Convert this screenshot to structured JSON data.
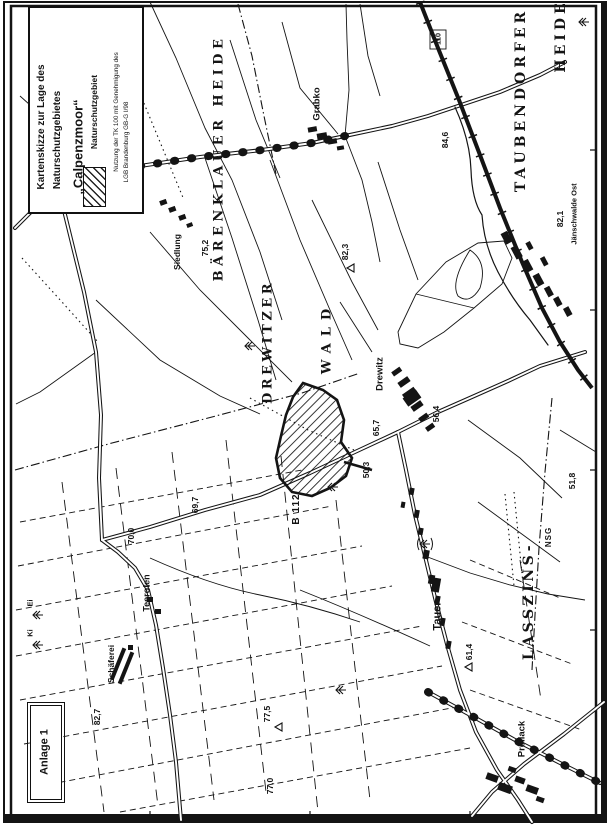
{
  "legend": {
    "title_line1": "Kartenskizze zur Lage des",
    "title_line2": "Naturschutzgebietes",
    "title_line3": "„Calpenzmoor“",
    "swatch_label": "Naturschutzgebiet",
    "note_line1": "Nutzung der TK 100 mit Genehmigung des",
    "note_line2": "LGB Brandenburg GB-G I/98"
  },
  "annotation_box": {
    "label": "Anlage 1"
  },
  "map": {
    "areas": {
      "barenklauer_heide": "BÄRENKLAUER HEIDE",
      "drewitzer": "DREWITZER",
      "wald": "WALD",
      "taubendorfer": "TAUBENDORFER",
      "heide": "HEIDE",
      "lasszins": "LASSZINS-",
      "nsg": "NSG"
    },
    "places": {
      "vorwerk": "Vorwerk",
      "grabko": "Grabko",
      "siedlung": "Siedlung",
      "drewitz": "Drewitz",
      "tauer": "Tauer",
      "teerofen": "Teerofen",
      "schaeferei": "Schäferei",
      "preilack": "Preilack",
      "jaenschwalde_ost": "Jänschwalde Ost",
      "ei": "Ei",
      "ki": "Ki"
    },
    "roads": {
      "b112": "B 112",
      "road_110": "110"
    },
    "elevations": {
      "e75_2": "75,2",
      "e82_3": "82,3",
      "e84_6": "84,6",
      "e82_1": "82,1",
      "e69_7": "69,7",
      "e70_0": "70,0",
      "e82_7": "82,7",
      "e77_5": "77,5",
      "e77_0": "77,0",
      "e61_4": "61,4",
      "e51_8": "51,8",
      "e65_7": "65,7",
      "e50_3": "50,3",
      "e56_4": "56,4"
    },
    "colors": {
      "ink": "#141414",
      "paper": "#ffffff"
    }
  }
}
